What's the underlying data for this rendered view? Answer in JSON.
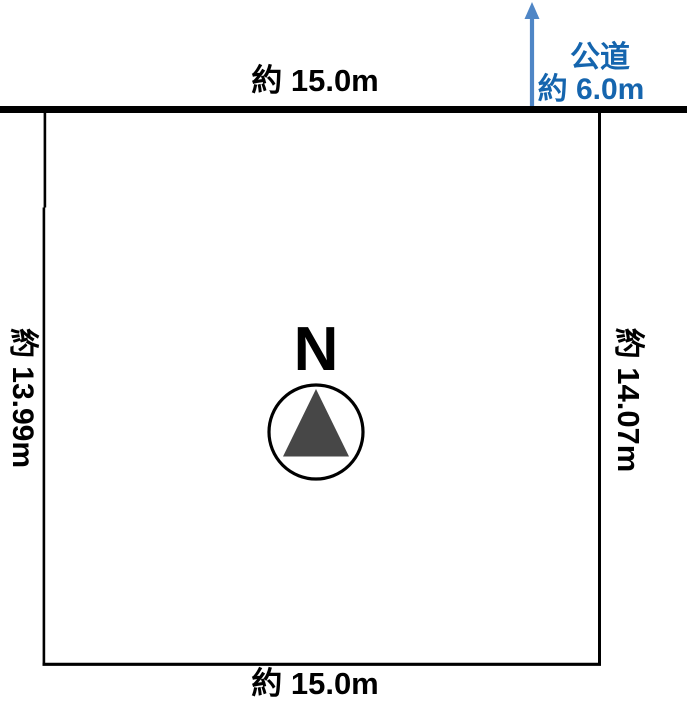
{
  "diagram": {
    "type": "land-plot",
    "top_dimension": "約 15.0m",
    "bottom_dimension": "約 15.0m",
    "left_dimension": "約 13.99m",
    "right_dimension": "約 14.07m",
    "road": {
      "name": "公道",
      "width": "約 6.0m"
    },
    "compass": {
      "north_label": "N"
    },
    "colors": {
      "boundary_line": "#000000",
      "road_line": "#000000",
      "road_text": "#1565ae",
      "arrow": "#4f86c6",
      "compass_triangle": "#474747",
      "background": "#ffffff"
    }
  }
}
